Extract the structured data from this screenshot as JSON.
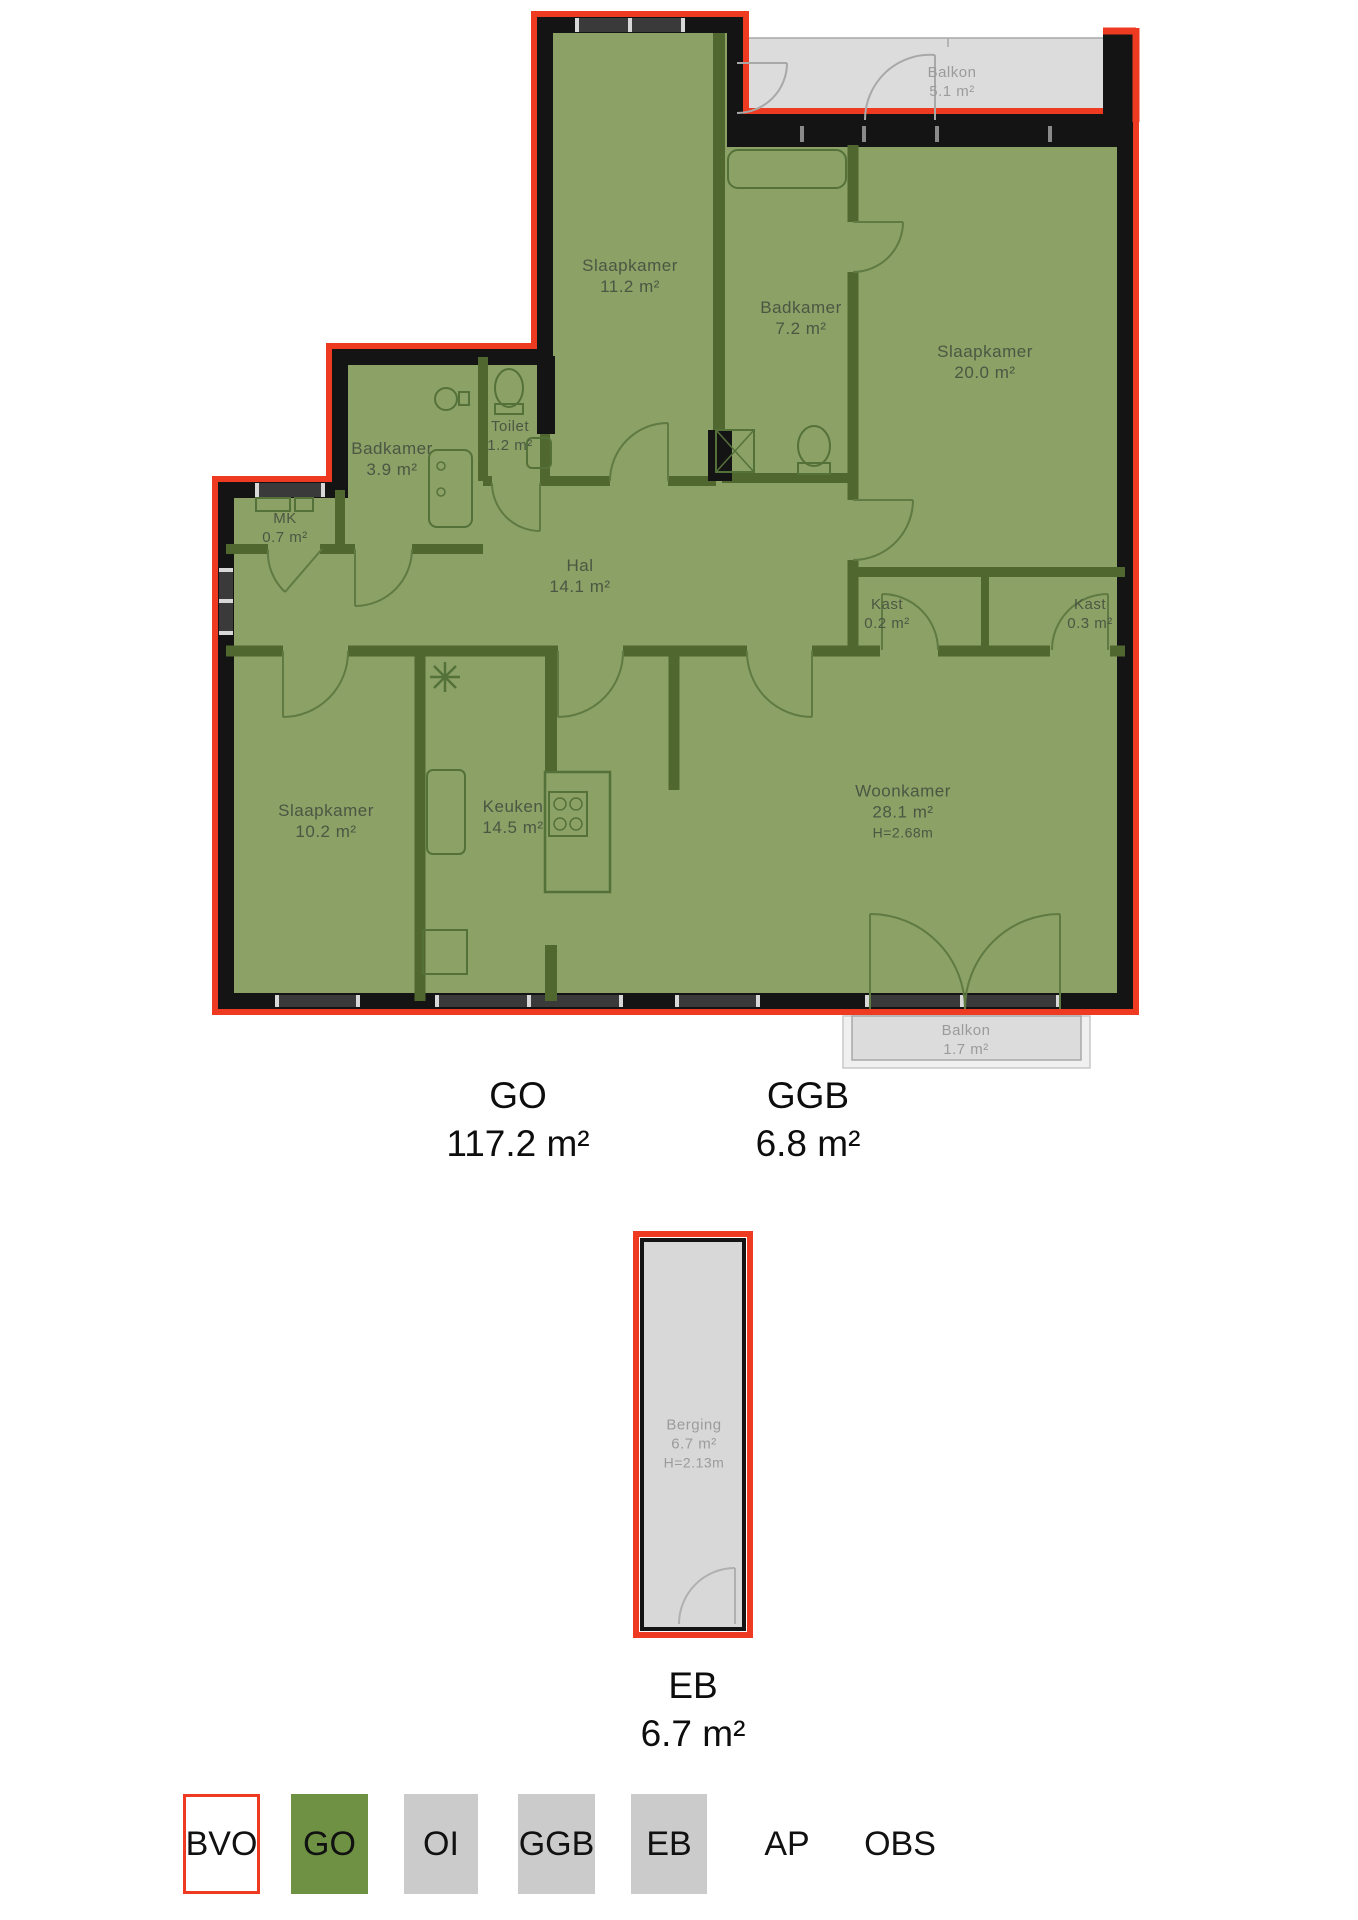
{
  "floorplan": {
    "rooms": [
      {
        "name": "Slaapkamer",
        "area": "11.2 m²"
      },
      {
        "name": "Badkamer",
        "area": "7.2 m²"
      },
      {
        "name": "Slaapkamer",
        "area": "20.0 m²"
      },
      {
        "name": "Balkon",
        "area": "5.1 m²"
      },
      {
        "name": "Badkamer",
        "area": "3.9 m²"
      },
      {
        "name": "Toilet",
        "area": "1.2 m²"
      },
      {
        "name": "MK",
        "area": "0.7 m²"
      },
      {
        "name": "Hal",
        "area": "14.1 m²"
      },
      {
        "name": "Kast",
        "area": "0.2 m²"
      },
      {
        "name": "Kast",
        "area": "0.3 m²"
      },
      {
        "name": "Slaapkamer",
        "area": "10.2 m²"
      },
      {
        "name": "Keuken",
        "area": "14.5 m²"
      },
      {
        "name": "Woonkamer",
        "area": "28.1 m²",
        "ceiling_height": "H=2.68m"
      },
      {
        "name": "Balkon",
        "area": "1.7 m²"
      }
    ],
    "storage_unit": {
      "name": "Berging",
      "area": "6.7 m²",
      "ceiling_height": "H=2.13m"
    }
  },
  "areas": {
    "go": {
      "label": "GO",
      "value": "117.2 m²"
    },
    "ggb": {
      "label": "GGB",
      "value": "6.8 m²"
    },
    "eb": {
      "label": "EB",
      "value": "6.7 m²"
    }
  },
  "legend": {
    "items": [
      {
        "label": "BVO",
        "fill": "#ffffff",
        "border": "#ee3a21"
      },
      {
        "label": "GO",
        "fill": "#6e9144",
        "border": "none"
      },
      {
        "label": "OI",
        "fill": "#cbcbcb",
        "border": "none"
      },
      {
        "label": "GGB",
        "fill": "#cbcbcb",
        "border": "none"
      },
      {
        "label": "EB",
        "fill": "#cbcbcb",
        "border": "none"
      },
      {
        "label": "AP",
        "fill": "none",
        "border": "none"
      },
      {
        "label": "OBS",
        "fill": "none",
        "border": "none"
      }
    ]
  },
  "colors": {
    "bvo_outline_red": "#ee3a21",
    "go_room_fill": "#8ba166",
    "go_legend_green": "#6e9144",
    "exterior_wall_black": "#141414",
    "interior_wall_green": "#50682f",
    "balcony_gray": "#dcdcdc",
    "legend_gray": "#cbcbcb"
  }
}
